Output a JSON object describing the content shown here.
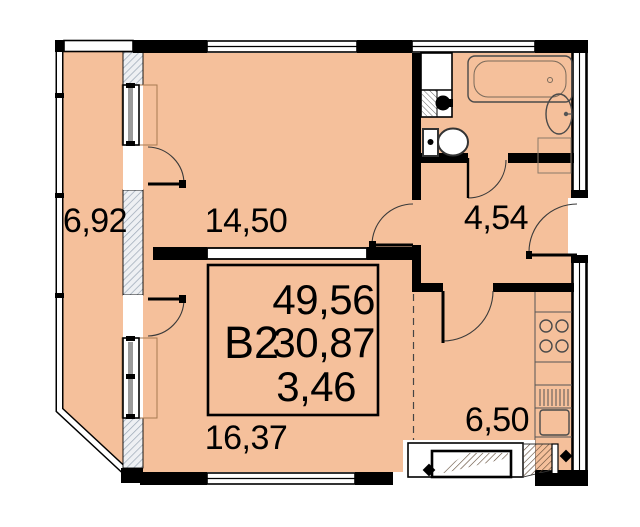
{
  "plan": {
    "unit": {
      "code": "B2",
      "total_area": "49,56",
      "living_area": "30,87",
      "extra_area": "3,46"
    },
    "rooms": {
      "balcony": "6,92",
      "bedroom": "14,50",
      "hallway": "4,54",
      "living": "16,37",
      "kitchen": "6,50"
    },
    "colors": {
      "floor": "#f5c09b",
      "wall": "#000000",
      "hatch": "#9aa7b5"
    }
  }
}
